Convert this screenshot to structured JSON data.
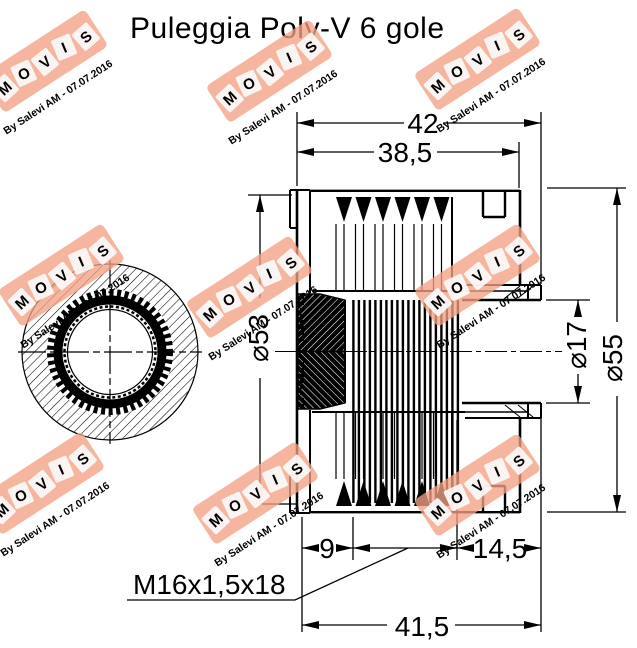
{
  "title": "Puleggia Poly-V 6 gole",
  "drawing": {
    "dimensions": {
      "overall_width": "42",
      "grooved_width": "38,5",
      "flange_diameter": "⌀53",
      "bore_diameter": "⌀17",
      "outer_diameter": "⌀55",
      "thread_depth": "9",
      "hub_offset": "14,5",
      "body_length": "41,5",
      "thread_spec": "M16x1,5x18"
    }
  },
  "watermark": {
    "letters": [
      "M",
      "O",
      "V",
      "I",
      "S"
    ],
    "byline": "By Salevi AM - 07.07.2016",
    "colors": {
      "box": "#f2a083",
      "tile": "#fbfbfb",
      "letter": "#5b9bd5",
      "byline": "#8f8f8f"
    }
  }
}
